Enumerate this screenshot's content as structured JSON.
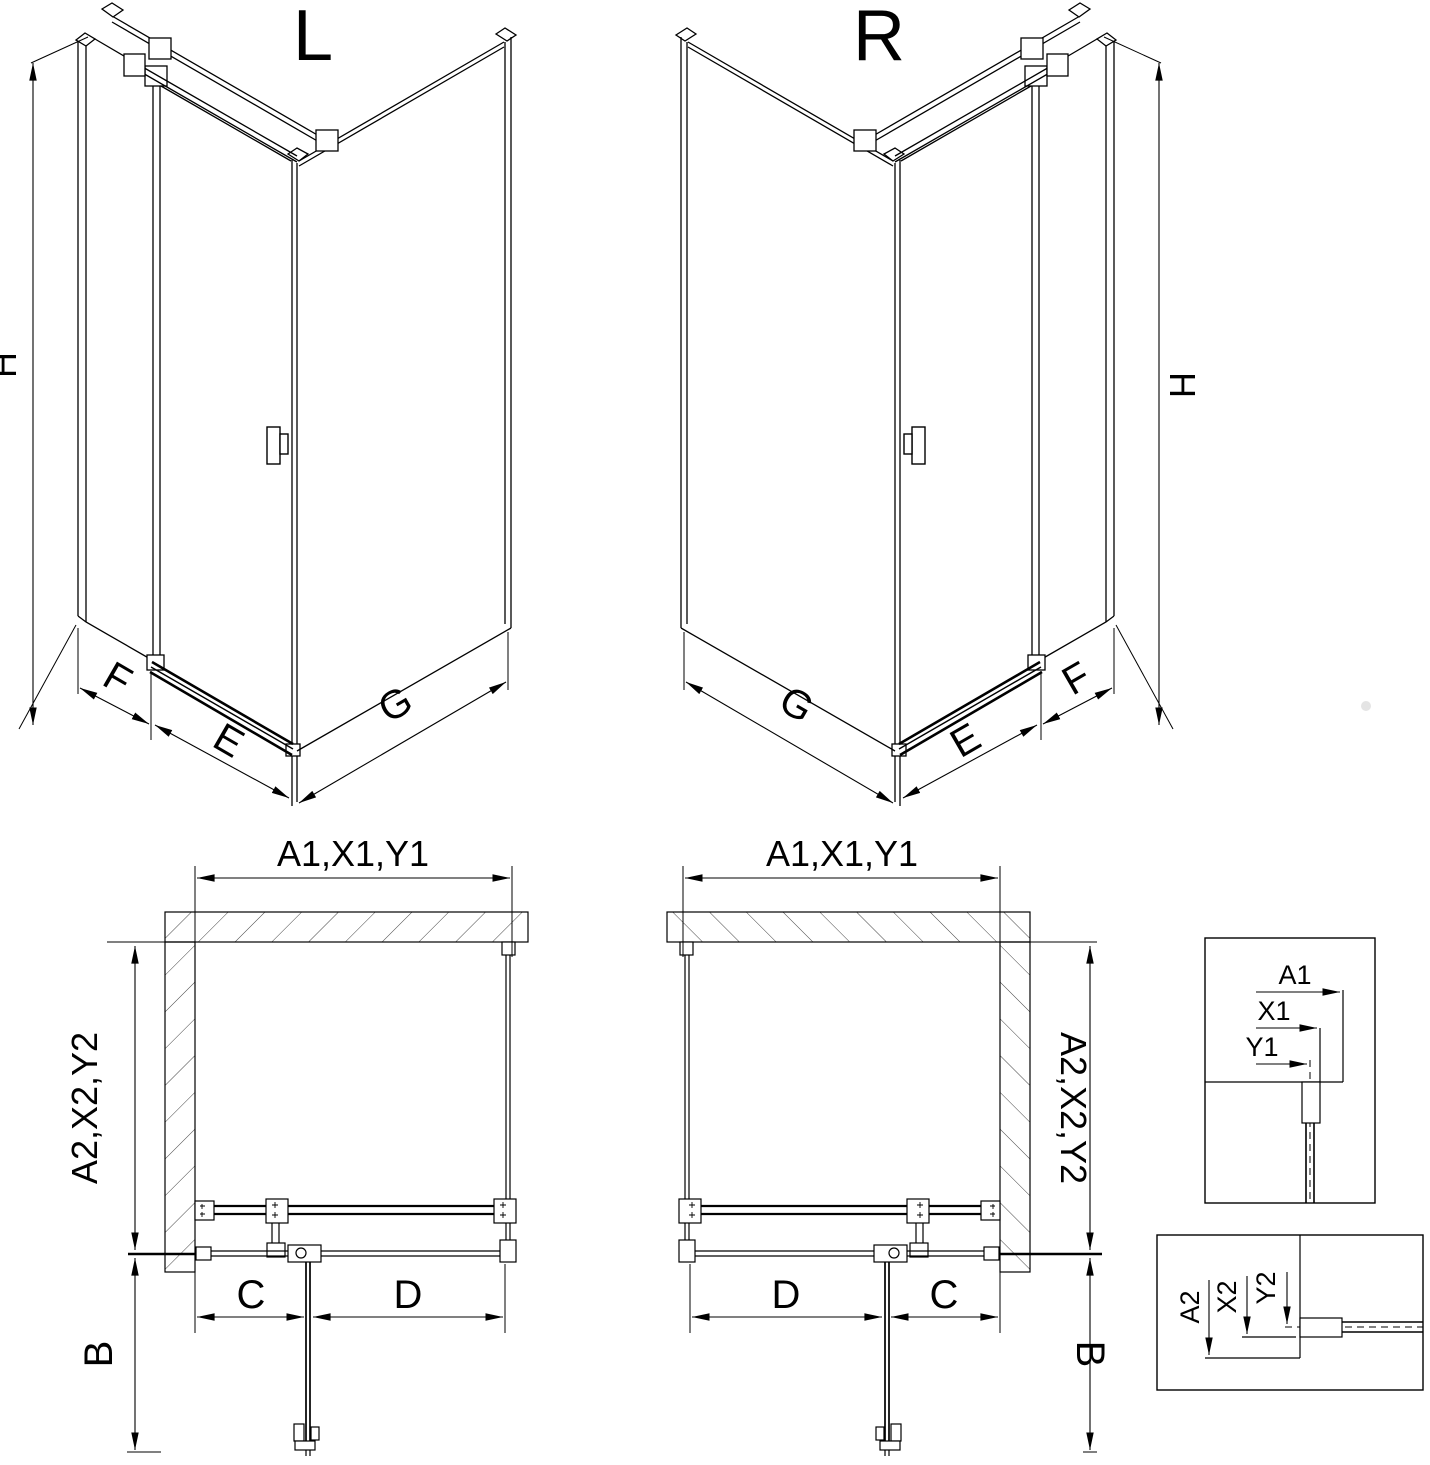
{
  "drawing": {
    "type": "shower-enclosure-installation-diagram",
    "line_color": "#000000",
    "background": "#ffffff",
    "views": {
      "iso_left": {
        "title": "L",
        "height_dim": "H",
        "side_panel_dim": "F",
        "door_dim": "E",
        "back_panel_dim": "G"
      },
      "iso_right": {
        "title": "R",
        "height_dim": "H",
        "side_panel_dim": "F",
        "door_dim": "E",
        "back_panel_dim": "G"
      },
      "plan_left": {
        "width_dim": "A1,X1,Y1",
        "depth_dim": "A2,X2,Y2",
        "door_swing_dim": "B",
        "wall_to_hinge_dim": "C",
        "hinge_to_corner_dim": "D"
      },
      "plan_right": {
        "width_dim": "A1,X1,Y1",
        "depth_dim": "A2,X2,Y2",
        "door_swing_dim": "B",
        "wall_to_hinge_dim": "C",
        "hinge_to_corner_dim": "D"
      },
      "detail_top": {
        "a1": "A1",
        "x1": "X1",
        "y1": "Y1"
      },
      "detail_bottom": {
        "a2": "A2",
        "x2": "X2",
        "y2": "Y2"
      }
    }
  }
}
